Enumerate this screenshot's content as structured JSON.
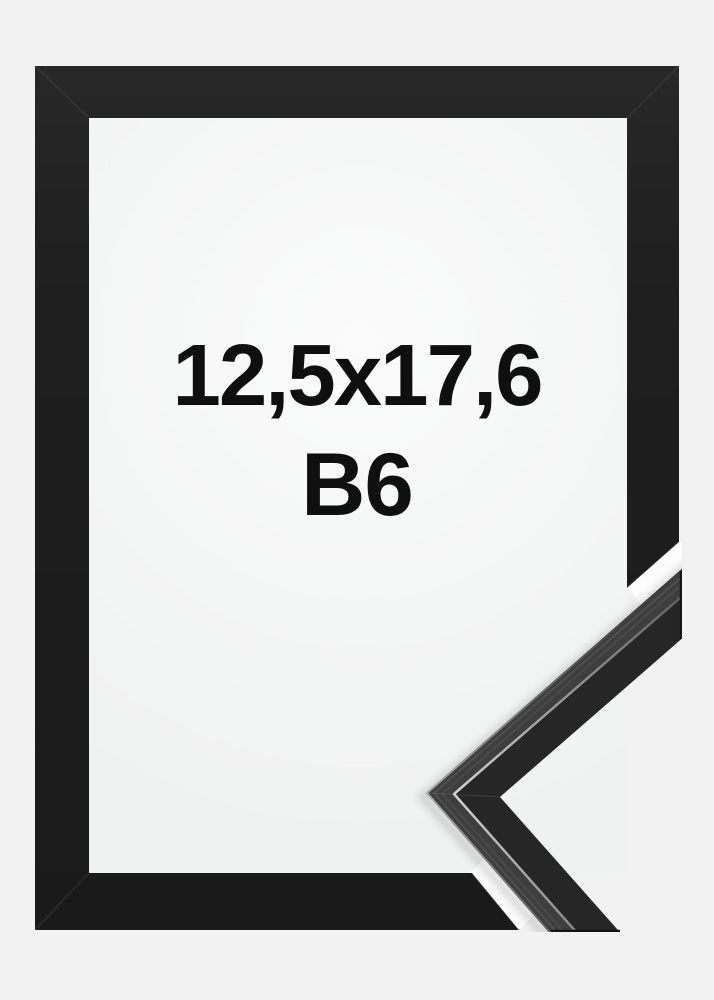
{
  "photo": {
    "size_label": "12,5x17,6",
    "format_label": "B6"
  },
  "colors": {
    "background": "#f2f2f2",
    "window": "#f4f5f5",
    "frame_black": "#1d1d1d",
    "cut_gap_white": "#fdfdfd",
    "moulding_front": "#262626",
    "moulding_top": "#3e3e3e",
    "label_text": "#0f0f0f"
  }
}
